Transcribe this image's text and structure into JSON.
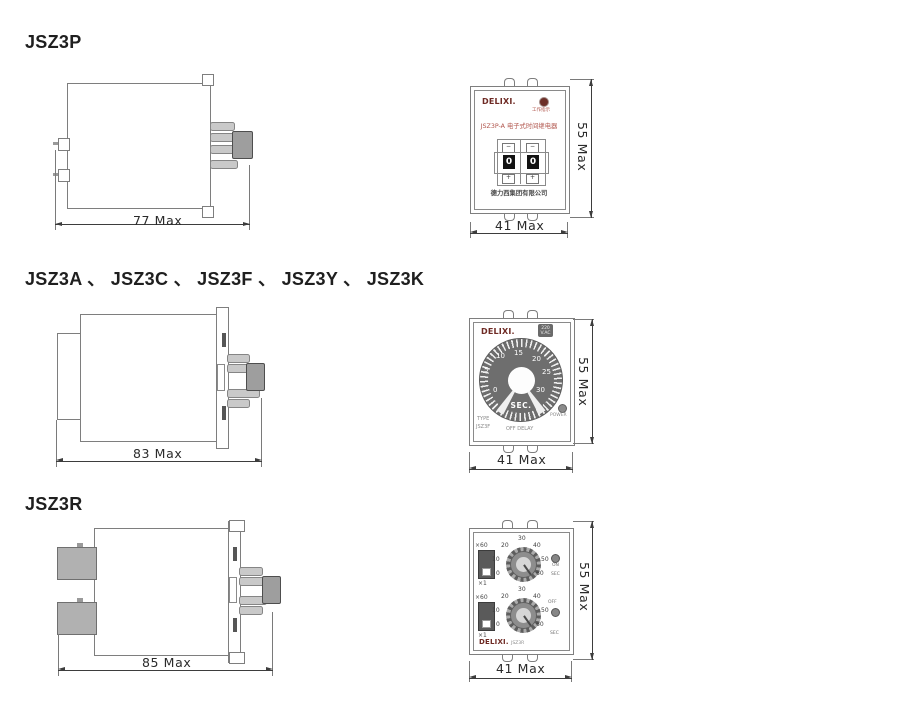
{
  "colors": {
    "brand_maroon": "#6e2a24",
    "accent_red": "#b0544b",
    "dial_gray": "#6e6e6e",
    "outline_gray": "#7e7e7e",
    "pin_gray": "#c9c9c9",
    "connector_gray": "#9e9e9e",
    "dim_text": "#2b2b2b"
  },
  "sections": [
    {
      "heading": "JSZ3P",
      "side": {
        "length_dim": "77 Max"
      },
      "front": {
        "brand": "DELIXI.",
        "indicator_label": "工作指示",
        "title": "JSZ3P-A 电子式时间继电器",
        "wheel": {
          "minus": "−",
          "plus": "+",
          "digits": [
            "0",
            "0"
          ]
        },
        "company": "德力西集团有限公司",
        "width_dim": "41 Max",
        "height_dim": "55 Max"
      }
    },
    {
      "heading": "JSZ3A 、 JSZ3C 、 JSZ3F 、 JSZ3Y 、 JSZ3K",
      "side": {
        "length_dim": "83 Max"
      },
      "front": {
        "brand": "DELIXI.",
        "badge": [
          "220",
          "V.AC"
        ],
        "dial": {
          "numbers": [
            "0",
            "5",
            "10",
            "15",
            "20",
            "25",
            "30"
          ],
          "unit": "SEC."
        },
        "type_label": "TYPE",
        "type_value": "JSZ3F",
        "mode_label": "OFF DELAY",
        "power_label": "POWER",
        "width_dim": "41 Max",
        "height_dim": "55 Max"
      }
    },
    {
      "heading": "JSZ3R",
      "side": {
        "length_dim": "85 Max"
      },
      "front": {
        "brand": "DELIXI.",
        "model": "JSZ3R",
        "knobs": [
          {
            "range_top": "×60",
            "range_bottom": "×1",
            "scale": [
              "0",
              "10",
              "20",
              "30",
              "40",
              "50",
              "60"
            ],
            "led_label": "ON",
            "unit": "SEC"
          },
          {
            "range_top": "×60",
            "range_bottom": "×1",
            "scale": [
              "0",
              "10",
              "20",
              "30",
              "40",
              "50",
              "60"
            ],
            "led_label": "OFF",
            "unit": "SEC"
          }
        ],
        "width_dim": "41 Max",
        "height_dim": "55 Max"
      }
    }
  ]
}
